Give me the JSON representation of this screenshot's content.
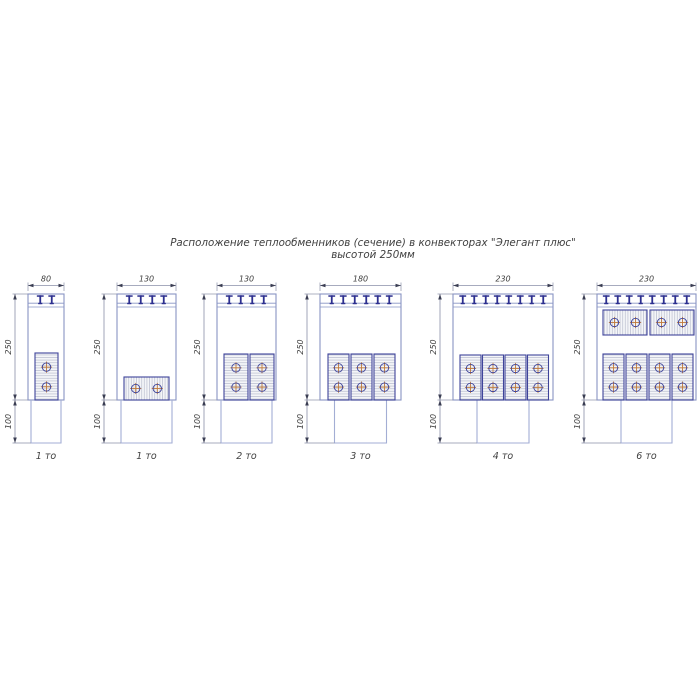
{
  "title": {
    "line1": "Расположение теплообменников (сечение) в конвекторах \"Элегант плюс\"",
    "line2": "высотой 250мм"
  },
  "colors": {
    "body_line": "#8894c4",
    "leg_line": "#a3aed4",
    "clip": "#2c2f8f",
    "exchanger_border": "#3f449a",
    "hatch": "#c0c4d4",
    "tube_stroke": "#3f449a",
    "tube_cross": "#c07a3a",
    "dim_line": "#8a8fa8",
    "arrow": "#3a3d52",
    "text": "#404040"
  },
  "shared_geometry": {
    "body_top": 294,
    "grille_line1": 303.2,
    "grille_line2": 307,
    "body_bottom": 400,
    "leg_bottom": 443,
    "dim_line_y": 285.5,
    "dim_text_y": 281.5,
    "ext_top_y": 282.5,
    "label_y": 459,
    "vdim_offset": 13,
    "clip_spacing": 11.5
  },
  "diagrams": [
    {
      "label": "1 то",
      "dim_width": "80",
      "dim_height": "250",
      "dim_leg": "100",
      "clips": 2,
      "geom": {
        "left": 28,
        "body_w": 36,
        "leg_w": 30,
        "groups": [
          {
            "orient": "v",
            "count": 1,
            "x": 35,
            "w": 23,
            "gap": 0,
            "y": 353,
            "h": 47
          }
        ]
      }
    },
    {
      "label": "1 то",
      "dim_width": "130",
      "dim_height": "250",
      "dim_leg": "100",
      "clips": 4,
      "geom": {
        "left": 117,
        "body_w": 59,
        "leg_w": 51,
        "groups": [
          {
            "orient": "h",
            "count": 1,
            "x": 124,
            "w": 45,
            "gap": 0,
            "y": 377,
            "h": 23
          }
        ]
      }
    },
    {
      "label": "2 то",
      "dim_width": "130",
      "dim_height": "250",
      "dim_leg": "100",
      "clips": 4,
      "geom": {
        "left": 217,
        "body_w": 59,
        "leg_w": 51,
        "groups": [
          {
            "orient": "v",
            "count": 2,
            "x": 224,
            "w": 24,
            "gap": 2,
            "y": 354,
            "h": 46
          }
        ]
      }
    },
    {
      "label": "3 то",
      "dim_width": "180",
      "dim_height": "250",
      "dim_leg": "100",
      "clips": 6,
      "geom": {
        "left": 320,
        "body_w": 81,
        "leg_w": 52,
        "groups": [
          {
            "orient": "v",
            "count": 3,
            "x": 328,
            "w": 21,
            "gap": 2,
            "y": 354,
            "h": 46
          }
        ]
      }
    },
    {
      "label": "4 то",
      "dim_width": "230",
      "dim_height": "250",
      "dim_leg": "100",
      "clips": 8,
      "geom": {
        "left": 453,
        "body_w": 100,
        "leg_w": 52,
        "groups": [
          {
            "orient": "v",
            "count": 4,
            "x": 460,
            "w": 21,
            "gap": 1.5,
            "y": 355,
            "h": 45
          }
        ]
      }
    },
    {
      "label": "6 то",
      "dim_width": "230",
      "dim_height": "250",
      "dim_leg": "100",
      "clips": 8,
      "geom": {
        "left": 597,
        "body_w": 99,
        "leg_w": 51,
        "groups": [
          {
            "orient": "h",
            "count": 2,
            "x": 603,
            "w": 44,
            "gap": 3,
            "y": 310,
            "h": 25
          },
          {
            "orient": "v",
            "count": 4,
            "x": 603,
            "w": 21,
            "gap": 2,
            "y": 354,
            "h": 46
          }
        ]
      }
    }
  ]
}
